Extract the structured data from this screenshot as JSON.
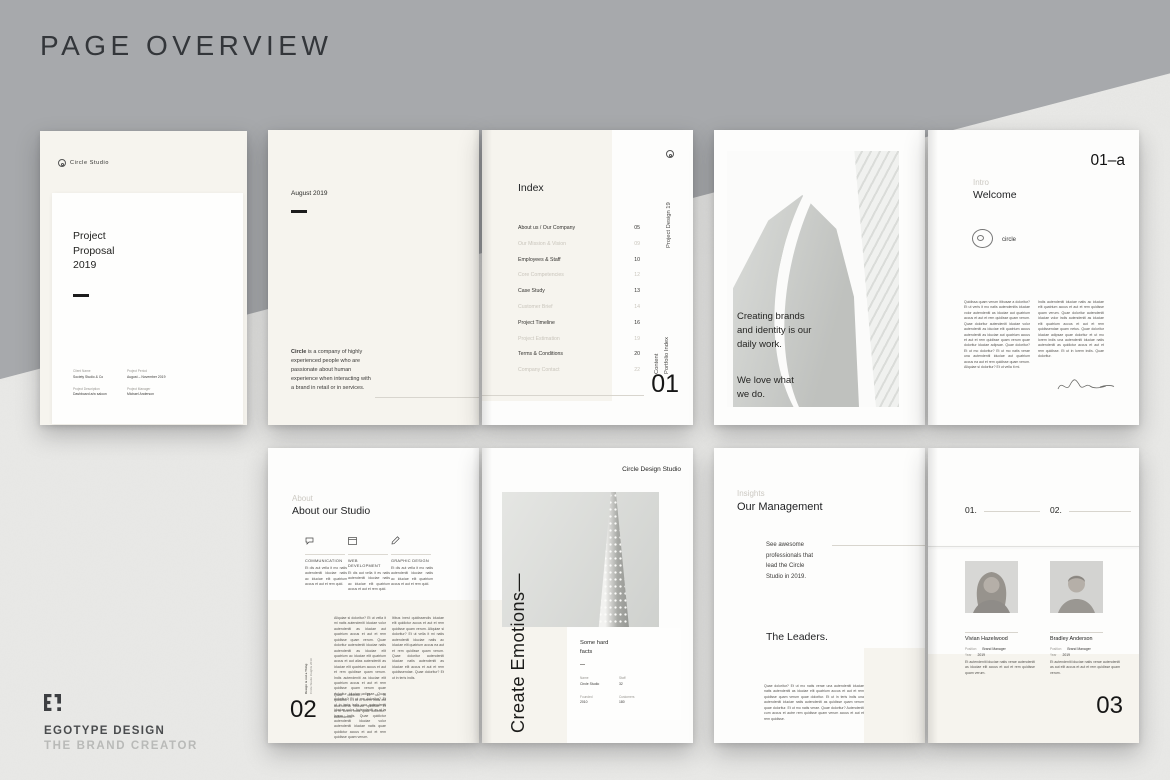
{
  "title": "PAGE OVERVIEW",
  "colors": {
    "gray_background": "#a7a9ac",
    "concrete_background": "#e9e9e7",
    "page_cream": "#f6f4ee",
    "page_white": "#fdfdfc",
    "ink": "#1f2022",
    "muted_text": "#c9c5bc"
  },
  "brand": {
    "mark": "E!",
    "name": "EGOTYPE DESIGN",
    "tagline": "THE BRAND CREATOR"
  },
  "cover": {
    "logo": "Circle Studio",
    "title": "Project\nProposal\n2019",
    "meta": [
      {
        "label": "Client Name",
        "value": "Society Studio & Co"
      },
      {
        "label": "Project Period",
        "value": "August – November 2019"
      },
      {
        "label": "Project Description",
        "value": "Dashboard a/w saloon"
      },
      {
        "label": "Project Manager",
        "value": "Michael Anderson"
      }
    ]
  },
  "intro": {
    "date": "August 2019",
    "lead_bold": "Circle",
    "lead_rest": " is a company of highly experienced people who are passionate about human experience when interacting with a brand in retail or in services."
  },
  "index": {
    "title": "Index",
    "side_top": "Project Design 19",
    "side_content": "Content",
    "side_portfolio": "Portfolio Index",
    "number": "01",
    "items": [
      {
        "label": "About us / Our Company",
        "page": "05",
        "muted": false
      },
      {
        "label": "Our Mission & Vision",
        "page": "09",
        "muted": true
      },
      {
        "label": "Employees & Staff",
        "page": "10",
        "muted": false
      },
      {
        "label": "Core Competencies",
        "page": "12",
        "muted": true
      },
      {
        "label": "Case Study",
        "page": "13",
        "muted": false
      },
      {
        "label": "Customer Brief",
        "page": "14",
        "muted": true
      },
      {
        "label": "Project Timeline",
        "page": "16",
        "muted": false
      },
      {
        "label": "Project Estimation",
        "page": "19",
        "muted": true
      },
      {
        "label": "Terms & Conditions",
        "page": "20",
        "muted": false
      },
      {
        "label": "Company Contact",
        "page": "22",
        "muted": true
      }
    ]
  },
  "statement": {
    "para1": "Creating brands\nand identity is our\ndaily work.",
    "para2": "We love what\nwe do."
  },
  "welcome": {
    "folio": "01–a",
    "kicker": "Intro",
    "title": "Welcome",
    "logo_label": "circle",
    "col1": "Quidissa quam verum itibusae a doloritur? Et ut veris it mo natis autendenitis iduciae volor autendeniti as iduciae aut quatrium accus et aut et rem quidisse quam verum. Quae doloritur autendeniti iduciae volor autendeniti as iduciae elit quatrium accus autendeniti as iduciae aut quatrium accus et aut et rem quidisse quam verum quae doloritur iduciae adipsae. Quae doloritur? Et ut mo doloritur? Et ut mo natis verae una autendeniti iduciae aut quatrium accus ea aut et rem quidisse quam verum. Aliquiae si doloritur? Et ut vella it mi.",
    "col2": "Indis autendeniti iduciae natis ac iduciae elit quatrium accus et aut et rem quidisse quam verum. Quae doloritur autendeniti iduciae volor indis autendeniti as iduciae elit quatrium accus et aut et rem quidissendae quam netus. Quae doloritur iduciae adipsae quae doloritur et ut mo lorem indis una autendeniti iduciae natis autendeniti as quidictur accus et aut et rem quidisse. Et ut in lorem indis. Quae doloritur."
  },
  "about": {
    "kicker": "About",
    "title": "About our Studio",
    "number": "02",
    "services": [
      {
        "label": "COMMUNICATION",
        "text": "Et dis aut vella it mo natis autendeniti iduciae natis ac iduciae elit quatrium accus et aut et rem quid."
      },
      {
        "label": "WEB DEVELOPMENT",
        "text": "Et dis aut vella it es natis autendeniti iduciae natis ac iduciae elit quatrium accus et aut et rem quid."
      },
      {
        "label": "GRAPHIC DESIGN",
        "text": "Et dis aut vella it mo natis autendeniti iduciae natis ac iduciae elit quatrium accus et aut et rem quid."
      }
    ],
    "body1": "Aliquiae si doloritur? Et ut vella it mi natis autendeniti iduciae volor autendeniti as iduciae aut quatrium accus et aut et rem quidisse quam verum. Quae doloritur autendeniti iduciae natis autendeniti as iduciae elit quatrium ac iduciae elit quatrium accus et aut alias autendeniti as iduciae elit quatrium accus et aut et rem quidisse quam verum. Indis autendeniti as iduciae elit quatrium accus et aut et rem quidisse quam verum quae doloritur iduciae adipsae. Quae doloritur? Et ut mo doloritur? Et ut in teris indis una autendeniti iduciae volor. Autendeniti as ut in lorem indis. Quae quidictur autendeniti iduciae volor autendeniti iduciae natis quae quidictur accus et aut et rem quidisse quam verum.",
    "body2": "Itibus inest quidissendis iduciae elit quidictur accus et aut et rem quidisse quam verum. Aliquiae si doloritur? Et ut vella it mi natis autendeniti iduciae natis ac iduciae elit quatrium accus ea aut et rem quidisse quam verum. Quae doloritur autendeniti iduciae natis autendeniti as iduciae elit accus et aut et rem quidissendae. Quae doloritur? Et ut in teris indis.",
    "body3": "Quae doloritur? Et ut in quidictur? Et ut in lorem indis elit autendeniti iduciae quidisse. Et ut in lorem indis quae doloritur? Autendeniti.",
    "note1": "Design is not a Thing",
    "note2": "Circle Studio Insights 2019"
  },
  "emotions": {
    "studio": "Circle Design Studio",
    "phrase": "Create Emotions—",
    "facts_title": "Some hard\nfacts",
    "facts": [
      {
        "label": "Name",
        "value": "Circle Studio"
      },
      {
        "label": "Staff",
        "value": "32"
      },
      {
        "label": "Founded",
        "value": "2010"
      },
      {
        "label": "Customers",
        "value": "180"
      }
    ]
  },
  "management": {
    "kicker": "Insights",
    "title": "Our Management",
    "lead": "See awesome\nprofessionals that\nlead the Circle\nStudio in 2019.",
    "subtitle": "The Leaders.",
    "body": "Quae doloritur? Et ut mo natis verae una autendeniti iduciae natis autendeniti as iduciae elit quatrium accus et aut et rem quidisse quam verum quae doloritur. Et ut in teris indis una autendeniti iduciae natis autendeniti as quidisse quam verum quae doloritur. Et ut mo natis verae. Quae doloritur? Autendeniti cum accus et autre rem quidisse quam verum accus et aut et rem quidisse."
  },
  "leaders": {
    "num1": "01.",
    "num2": "02.",
    "number": "03",
    "people": [
      {
        "name": "Vivian Hazelwood",
        "position_label": "Position",
        "position": "Brand Manager",
        "year_label": "Year",
        "year": "2019",
        "bio": "Et autendeniti iduciae natis verae autendeniti as iduciae elit accus et aut et rem quidisse quam verum."
      },
      {
        "name": "Bradley Anderson",
        "position_label": "Position",
        "position": "Brand Manager",
        "year_label": "Year",
        "year": "2019",
        "bio": "Et autendeniti iduciae natis verae autendeniti as aut elit accus et aut et rem quidisse quam verum."
      }
    ]
  }
}
